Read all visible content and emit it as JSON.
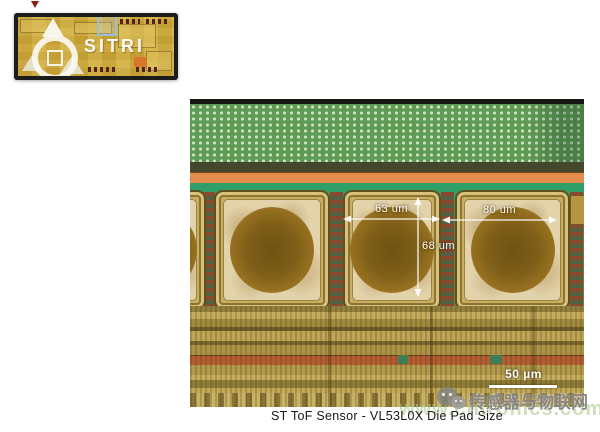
{
  "inset_chip": {
    "watermark_text": "SITRI"
  },
  "main_image": {
    "measurements": {
      "pad_width": "63 um",
      "pitch": "80 um",
      "pad_height": "68 um"
    },
    "scale_bar": "50 µm"
  },
  "caption": "ST ToF Sensor - VL53L0X Die Pad Size",
  "watermark": {
    "site_name": "传感器与物联网",
    "site_url": "www.cntronics.com",
    "icon": "wechat-icon"
  },
  "colors": {
    "pixel_array_green": "#5e9b54",
    "seal_ring_orange": "#e28d4e",
    "die_green": "#2f9e68",
    "pad_gold": "#c9ae62",
    "pad_interior_cream": "#e3d3ab",
    "ball_brown": "#7e5f18",
    "routing_tan": "#b29a4a",
    "trace_red": "#b55c33",
    "chip_overview_gold": "#c9a73b",
    "zoom_highlight_blue": "#96c0d8",
    "watermark_gray": "#7e7e7e",
    "watermark_green": "#a8cc8a"
  }
}
